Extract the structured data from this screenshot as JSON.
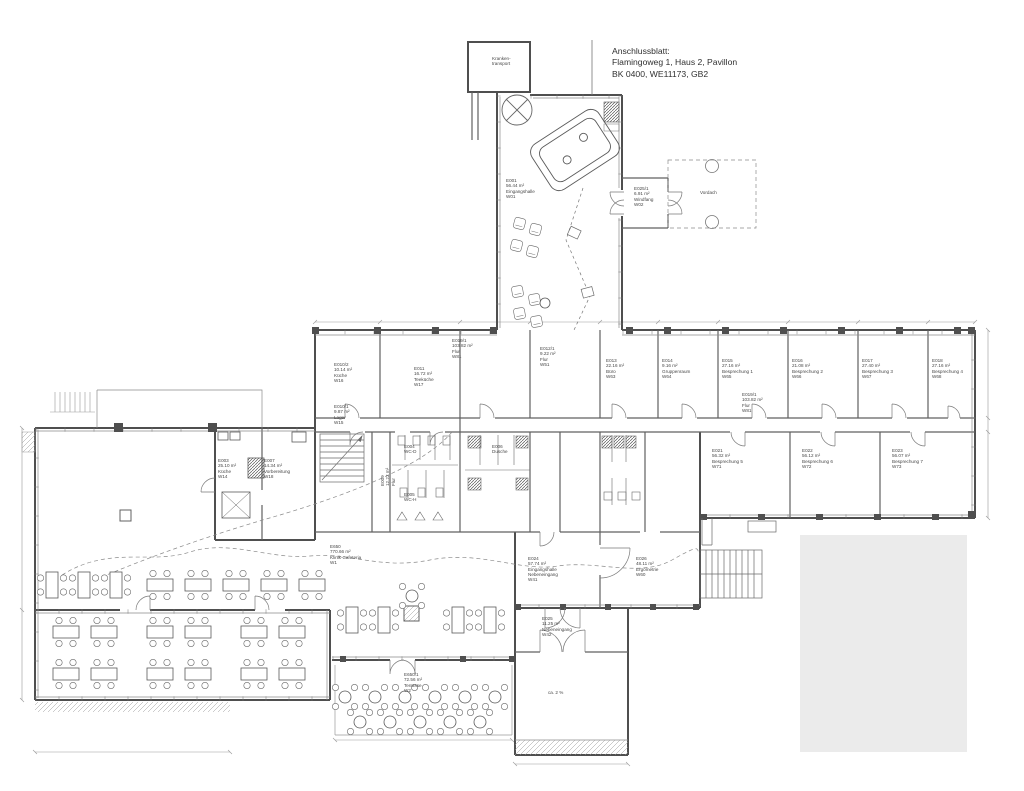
{
  "title_block": {
    "line1": "Anschlussblatt:",
    "line2": "Flamingoweg 1, Haus 2, Pavillon",
    "line3": "BK 0400,  WE11173,  GB2"
  },
  "colors": {
    "background": "#ffffff",
    "wall_dark": "#4f4f4f",
    "wall_mid": "#606060",
    "line_light": "#8a8a8a",
    "dim_line": "#9a9a9a",
    "label_text": "#474747",
    "mask_gray": "#ebebeb"
  },
  "room_labels": [
    {
      "x": 492,
      "y": 56,
      "rot": 0,
      "lines": [
        "Kranken-",
        "transport"
      ]
    },
    {
      "x": 506,
      "y": 178,
      "rot": 0,
      "lines": [
        "E001",
        "56.44 m²",
        "Eingangshalle",
        "W01"
      ]
    },
    {
      "x": 634,
      "y": 186,
      "rot": 0,
      "lines": [
        "E025/1",
        "6.91 m²",
        "Windfang",
        "W02"
      ]
    },
    {
      "x": 700,
      "y": 190,
      "rot": 0,
      "lines": [
        "Vordach"
      ]
    },
    {
      "x": 334,
      "y": 362,
      "rot": 0,
      "lines": [
        "E010/2",
        "10.14 m²",
        "Küche",
        "W16"
      ]
    },
    {
      "x": 334,
      "y": 404,
      "rot": 0,
      "lines": [
        "E010/1",
        "9.87 m²",
        "Lager",
        "W15"
      ]
    },
    {
      "x": 414,
      "y": 366,
      "rot": 0,
      "lines": [
        "E011",
        "16.72 m²",
        "Teeküche",
        "W17"
      ]
    },
    {
      "x": 452,
      "y": 338,
      "rot": 0,
      "lines": [
        "E019/1",
        "103.82 m²",
        "Flur",
        "W81"
      ]
    },
    {
      "x": 540,
      "y": 346,
      "rot": 0,
      "lines": [
        "E012/1",
        "9.22 m²",
        "Flur",
        "W51"
      ]
    },
    {
      "x": 606,
      "y": 358,
      "rot": 0,
      "lines": [
        "E013",
        "22.16 m²",
        "Büro",
        "W63"
      ]
    },
    {
      "x": 662,
      "y": 358,
      "rot": 0,
      "lines": [
        "E014",
        "9.16 m²",
        "Gruppenraum",
        "W64"
      ]
    },
    {
      "x": 722,
      "y": 358,
      "rot": 0,
      "lines": [
        "E015",
        "27.16 m²",
        "Besprechung 1",
        "W65"
      ]
    },
    {
      "x": 792,
      "y": 358,
      "rot": 0,
      "lines": [
        "E016",
        "21.08 m²",
        "Besprechung 2",
        "W66"
      ]
    },
    {
      "x": 862,
      "y": 358,
      "rot": 0,
      "lines": [
        "E017",
        "27.40 m²",
        "Besprechung 3",
        "W67"
      ]
    },
    {
      "x": 932,
      "y": 358,
      "rot": 0,
      "lines": [
        "E018",
        "27.16 m²",
        "Besprechung 4",
        "W68"
      ]
    },
    {
      "x": 742,
      "y": 392,
      "rot": 0,
      "lines": [
        "E019/1",
        "103.82 m²",
        "Flur",
        "W81"
      ]
    },
    {
      "x": 712,
      "y": 448,
      "rot": 0,
      "lines": [
        "E021",
        "56.32 m²",
        "Besprechung 5",
        "W71"
      ]
    },
    {
      "x": 802,
      "y": 448,
      "rot": 0,
      "lines": [
        "E022",
        "56.12 m²",
        "Besprechung 6",
        "W72"
      ]
    },
    {
      "x": 892,
      "y": 448,
      "rot": 0,
      "lines": [
        "E023",
        "56.07 m²",
        "Besprechung 7",
        "W73"
      ]
    },
    {
      "x": 218,
      "y": 458,
      "rot": 0,
      "lines": [
        "E003",
        "25.10 m²",
        "Küche",
        "W14"
      ]
    },
    {
      "x": 264,
      "y": 458,
      "rot": 0,
      "lines": [
        "E007",
        "14.34 m²",
        "Vorbereitung",
        "W18"
      ]
    },
    {
      "x": 380,
      "y": 486,
      "rot": -90,
      "lines": [
        "E009",
        "12.22 m²",
        "Flur"
      ]
    },
    {
      "x": 330,
      "y": 544,
      "rot": 0,
      "lines": [
        "E650",
        "770.66 m²",
        "Klinik-Cafeteria",
        "W1"
      ]
    },
    {
      "x": 528,
      "y": 556,
      "rot": 0,
      "lines": [
        "E024",
        "57.74 m²",
        "Eingangshalle",
        "Nebeneingang",
        "W41"
      ]
    },
    {
      "x": 636,
      "y": 556,
      "rot": 0,
      "lines": [
        "E026",
        "48.11 m²",
        "Ergometrie",
        "W60"
      ]
    },
    {
      "x": 542,
      "y": 616,
      "rot": 0,
      "lines": [
        "E025",
        "11.25 m²",
        "Nebeneingang",
        "W42"
      ]
    },
    {
      "x": 404,
      "y": 672,
      "rot": 0,
      "lines": [
        "E650/1",
        "72.56 m²",
        "Terrasse",
        "W2"
      ]
    },
    {
      "x": 404,
      "y": 444,
      "rot": 0,
      "lines": [
        "E004",
        "WC-D"
      ]
    },
    {
      "x": 404,
      "y": 492,
      "rot": 0,
      "lines": [
        "E005",
        "WC-H"
      ]
    },
    {
      "x": 492,
      "y": 444,
      "rot": 0,
      "lines": [
        "E006",
        "Dusche"
      ]
    },
    {
      "x": 548,
      "y": 690,
      "rot": 0,
      "lines": [
        "ca. 2 %"
      ]
    }
  ],
  "furniture": {
    "h_tables": [
      [
        160,
        585
      ],
      [
        198,
        585
      ],
      [
        236,
        585
      ],
      [
        274,
        585
      ],
      [
        312,
        585
      ],
      [
        66,
        632
      ],
      [
        104,
        632
      ],
      [
        160,
        632
      ],
      [
        198,
        632
      ],
      [
        254,
        632
      ],
      [
        292,
        632
      ],
      [
        66,
        674
      ],
      [
        104,
        674
      ],
      [
        160,
        674
      ],
      [
        198,
        674
      ],
      [
        254,
        674
      ],
      [
        292,
        674
      ]
    ],
    "v_tables": [
      [
        52,
        585
      ],
      [
        84,
        585
      ],
      [
        116,
        585
      ],
      [
        352,
        620
      ],
      [
        384,
        620
      ],
      [
        458,
        620
      ],
      [
        490,
        620
      ]
    ],
    "round_tables": [
      [
        345,
        697
      ],
      [
        375,
        697
      ],
      [
        405,
        697
      ],
      [
        435,
        697
      ],
      [
        465,
        697
      ],
      [
        495,
        697
      ],
      [
        360,
        722
      ],
      [
        390,
        722
      ],
      [
        420,
        722
      ],
      [
        450,
        722
      ],
      [
        480,
        722
      ],
      [
        412,
        596
      ]
    ],
    "armchairs": [
      [
        514,
        218,
        15
      ],
      [
        530,
        224,
        15
      ],
      [
        511,
        240,
        15
      ],
      [
        527,
        246,
        15
      ],
      [
        512,
        286,
        -10
      ],
      [
        529,
        294,
        -10
      ],
      [
        514,
        308,
        -10
      ],
      [
        531,
        316,
        -10
      ]
    ],
    "lobby_table": [
      545,
      303
    ]
  }
}
